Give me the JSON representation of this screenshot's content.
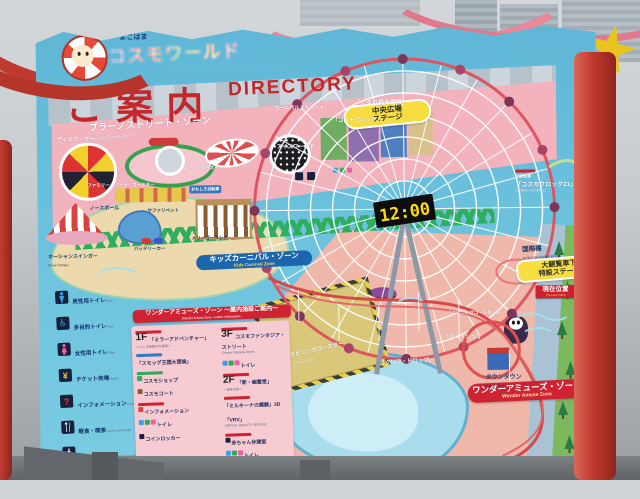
{
  "logo": {
    "kana": "よこはま",
    "name": "コスモワールド"
  },
  "title": {
    "jp": "ご案内",
    "en": "DIRECTORY"
  },
  "zones": {
    "burano": {
      "jp": "ブラーノストリート・ゾーン",
      "en": "Burano Street Zone"
    },
    "kids": {
      "jp": "キッズカーニバル・ゾーン",
      "en": "Kids Carnival Zone"
    },
    "wonder": {
      "jp": "ワンダーアミューズ・ゾーン",
      "en": "Wonder Amuse Zone"
    }
  },
  "stages": {
    "central_line1": "中央広場",
    "central_line2": "ステージ",
    "wheel_line1": "大観覧車下",
    "wheel_line2": "特設ステージ"
  },
  "marker": {
    "jp": "現在位置",
    "en": "You are here"
  },
  "bridge": {
    "jp": "国際橋",
    "en": "KOKUSAI-BASHI Bridge"
  },
  "ferris": {
    "tag": "大観覧車",
    "jp": "「コスモクロック21」",
    "en": "COSMO CLOCK 21",
    "clock": "12:00"
  },
  "rides": {
    "gururi": "「ぐるり森大冒険」",
    "cosmopanic": "「コスモパニック」",
    "carnival_street": "カーニバルストリート",
    "ice_world": "アイスワールド",
    "disk_o": "ディスク・オー",
    "banana": "ファミリー・バナナ・コースター",
    "super_planet": "スーパープラネット",
    "ocean_swinger_jp": "オーシャンスインガー",
    "ocean_swinger_en": "Ocean Swinger",
    "north_pole": "ノースポール",
    "safari_pet": "サファリペット",
    "battery_car": "バッテリーカー",
    "merry_go_round": "メリーゴーランド",
    "fun_cycle": "おもしろ自転車",
    "spinning_jp": "スピニングコースター",
    "spinning_en": "Spinning Coaster",
    "cliff_drop": "「クリフ・ドロップ」",
    "vanish": "「バニッシュ!」",
    "coaster2": "「スピニングコースター2」",
    "down_town_jp": "タウンタウン",
    "down_town_en": "Down Town"
  },
  "legend": [
    {
      "jp": "男性用トイレ",
      "en": "Toilet"
    },
    {
      "jp": "多目的トイレ",
      "en": "Toilet"
    },
    {
      "jp": "女性用トイレ",
      "en": "Toilet"
    },
    {
      "jp": "チケット売場",
      "en": "Tickets"
    },
    {
      "jp": "インフォメーション",
      "en": "Information"
    },
    {
      "jp": "軽食・喫茶",
      "en": "Foods & Beverage"
    },
    {
      "jp": "赤ちゃん休憩室",
      "en": "Baby Care Room"
    },
    {
      "jp": "コインロッカー",
      "en": "Baggage Locker"
    }
  ],
  "panel": {
    "header_jp": "ワンダーアミューズ・ゾーン ～屋内施設ご案内～",
    "header_en": "Wonder Amuse Zone ~Indoor Information~",
    "left": [
      {
        "floor": "1F",
        "label": "「ミラーアドベンチャー」",
        "sub": "～ふしぎ迷路の大冒険～"
      },
      {
        "label": "「スモッグ王国大冒険」"
      },
      {
        "label": "コスモショップ"
      },
      {
        "label": "コスモコート"
      },
      {
        "label": "インフォメーション"
      },
      {
        "label": "トイレ"
      },
      {
        "label": "コインロッカー"
      }
    ],
    "right": [
      {
        "floor": "3F",
        "label": "コスモファンタジア・ストリート",
        "sub": "Cosmo Fantasia Street"
      },
      {
        "label": "トイレ"
      },
      {
        "floor": "2F",
        "label": "「新・幽霊堂」",
        "sub": "～恐怖の旅～"
      },
      {
        "label": "「ミルキーナの魔鏡」3D"
      },
      {
        "label": "「VRV」",
        "sub": "VIRTUAL REALITY VEHICLE"
      },
      {
        "label": "赤ちゃん休憩室"
      },
      {
        "label": "トイレ"
      }
    ]
  },
  "colors": {
    "accent_red": "#cf2333",
    "water": "#6cc2dd",
    "clock_digits": "#ffd80e"
  }
}
